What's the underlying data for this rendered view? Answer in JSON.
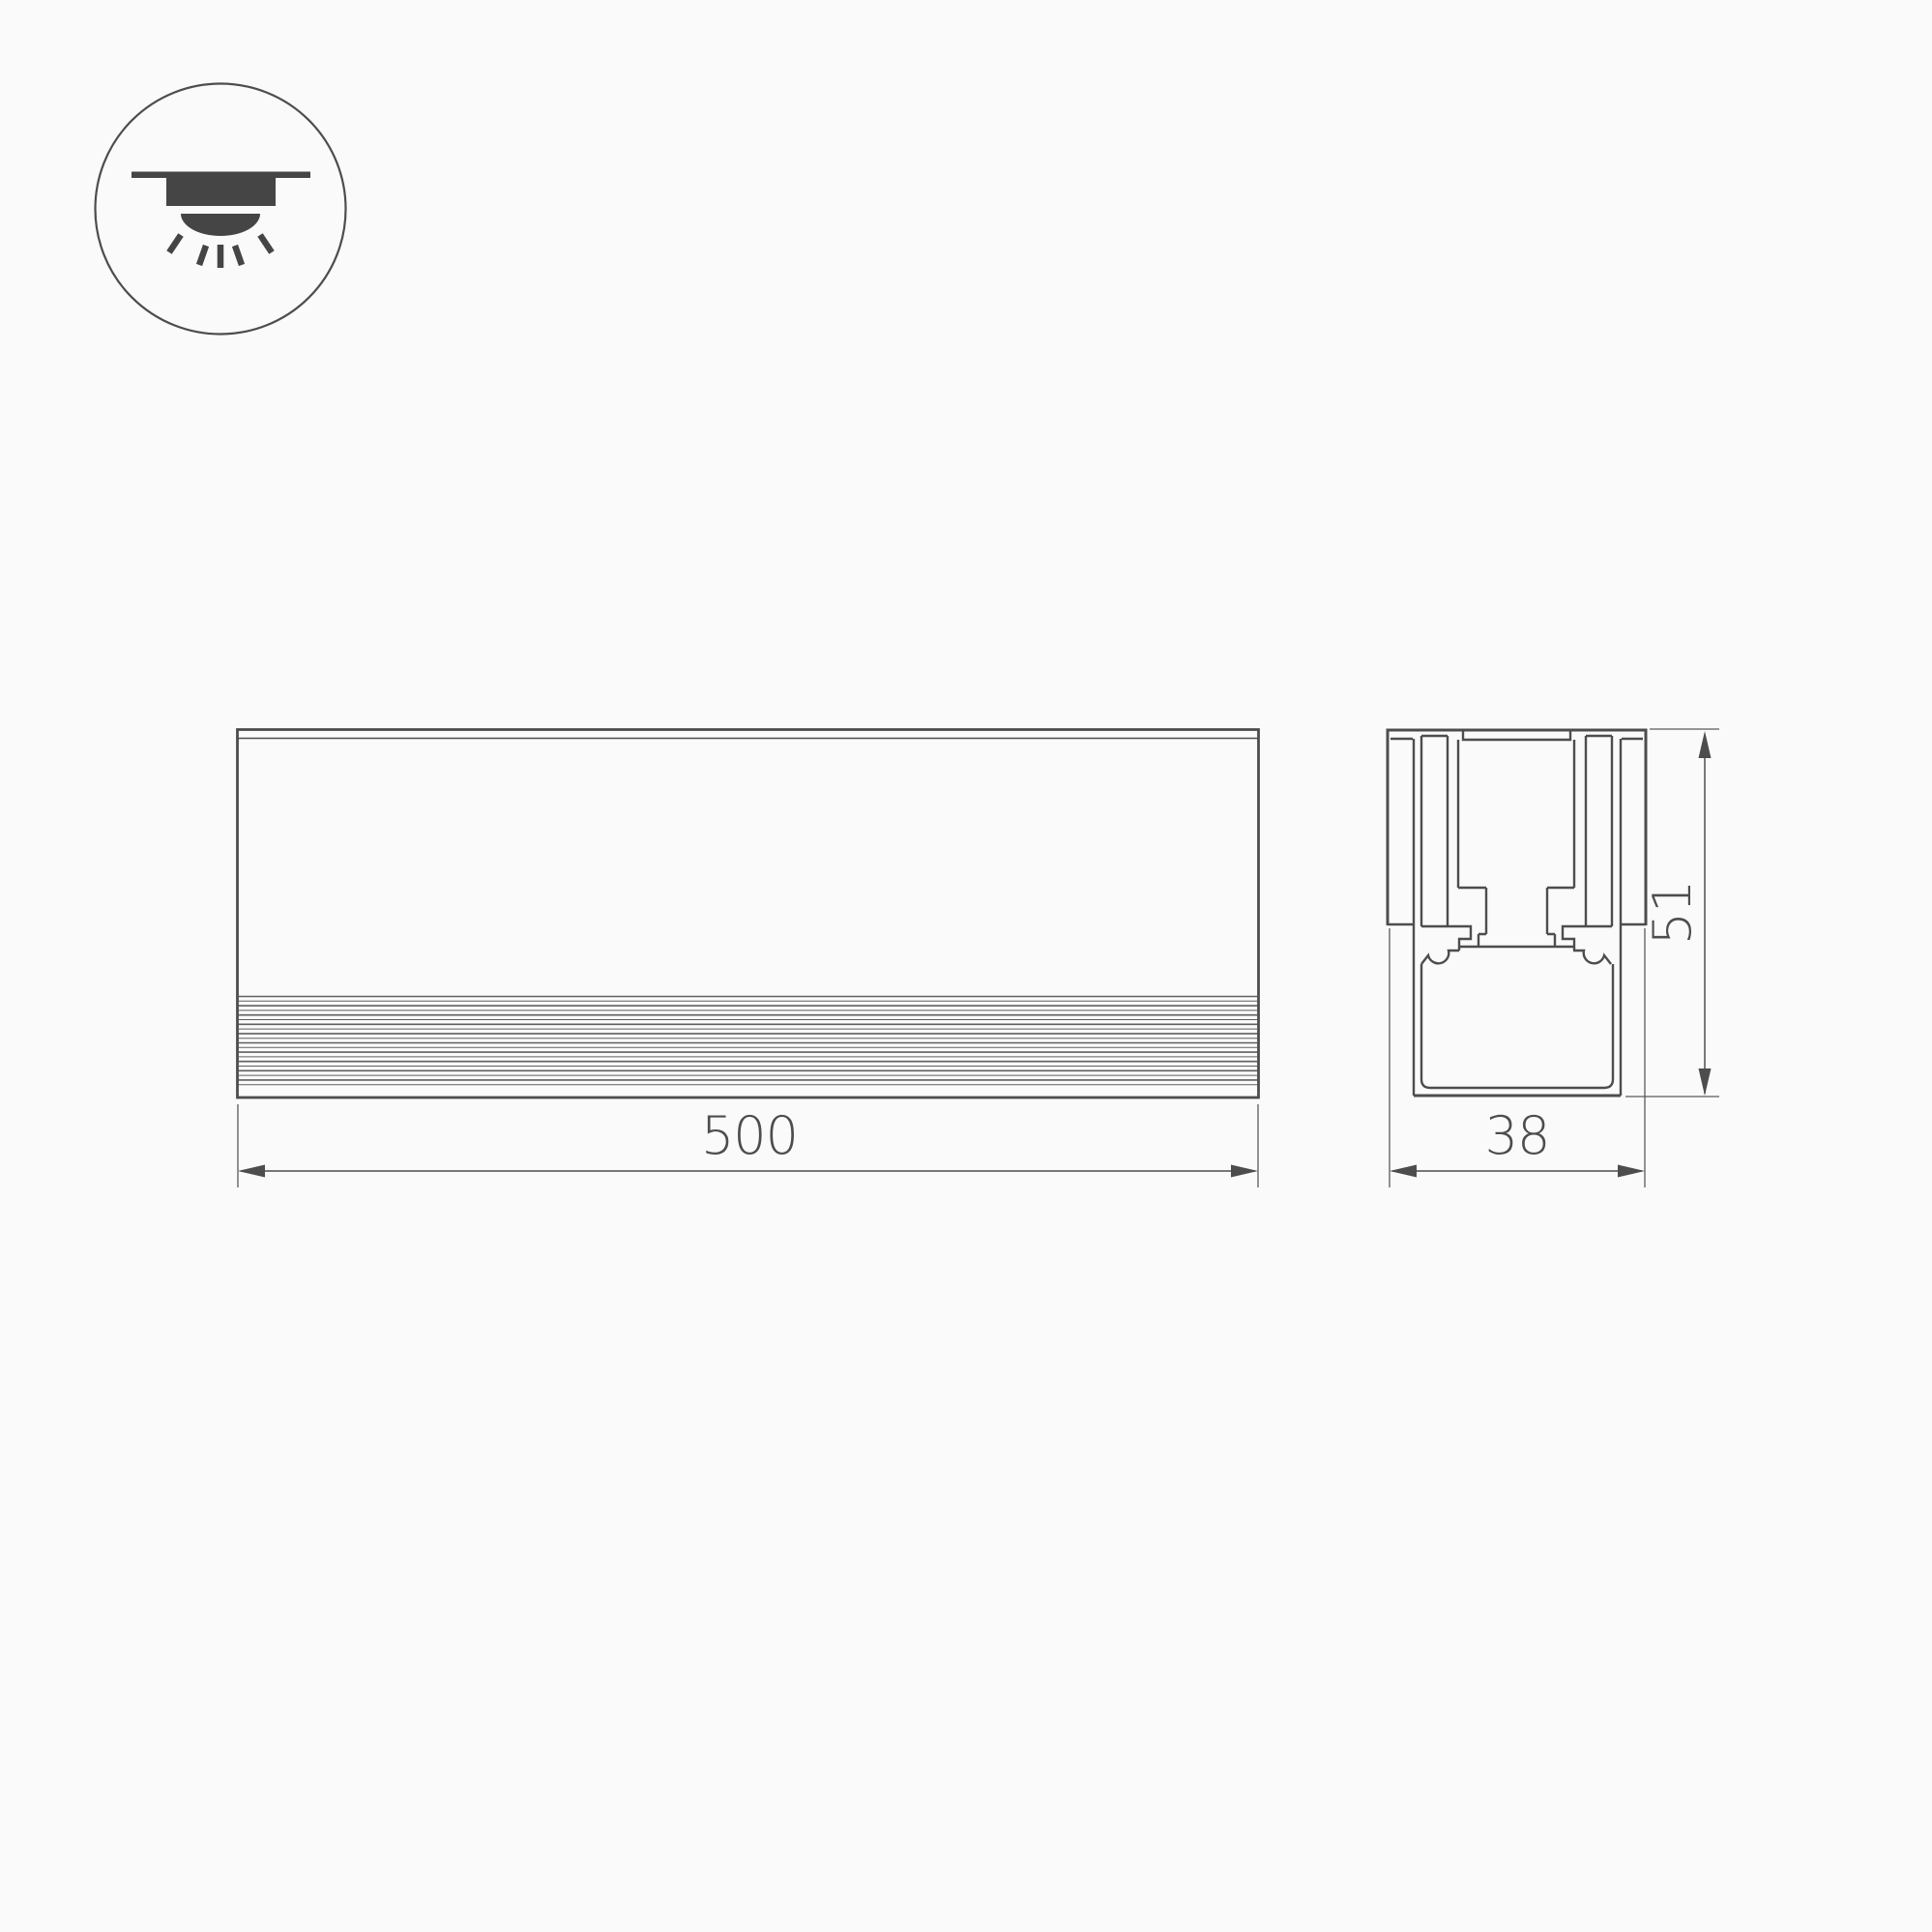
{
  "page": {
    "background": "#fafafa"
  },
  "drawing": {
    "type": "technical-dimension-drawing",
    "line_color": "#4d4d4d",
    "icon_fill_color": "#454545",
    "icon": "recessed-mount-downlight",
    "views": {
      "front": "front-view",
      "section": "cross-section-view"
    },
    "dimensions": {
      "length": "500",
      "width": "38",
      "height": "51"
    }
  }
}
